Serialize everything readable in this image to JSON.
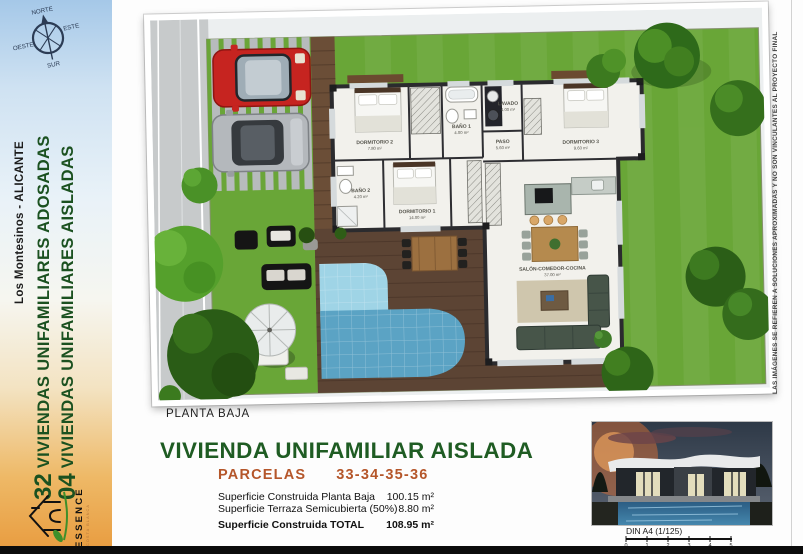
{
  "sidebar": {
    "location": "Los Montesinos - ALICANTE",
    "line1_number": "32",
    "line1_text": "VIVIENDAS UNIFAMILIARES ADOSADAS",
    "line2_number": "04",
    "line2_text": "VIVIENDAS UNIFAMILIARES AISLADAS",
    "logo_name": "ESSENCE",
    "logo_subtitle": "COSTA BLANCA",
    "colors": {
      "text_green": "#1b5120",
      "gradient_top": "#a5c8e8",
      "gradient_bottom": "#e89b3e"
    }
  },
  "compass": {
    "north": "NORTE",
    "east": "ESTE",
    "south": "SUR",
    "west": "OESTE"
  },
  "plan": {
    "caption": "PLANTA BAJA",
    "rooms": [
      {
        "name": "DORMITORIO 2",
        "area": "7.80 m²"
      },
      {
        "name": "BAÑO 1",
        "area": "4.00 m²"
      },
      {
        "name": "LAVADO",
        "area": "4.00 m²"
      },
      {
        "name": "DORMITORIO 3",
        "area": "9.60 m²"
      },
      {
        "name": "PASO",
        "area": "5.60 m²"
      },
      {
        "name": "BAÑO 2",
        "area": "4.20 m²"
      },
      {
        "name": "DORMITORIO 1",
        "area": "14.00 m²"
      },
      {
        "name": "SALÓN-COMEDOR-COCINA",
        "area": "37.00 m²"
      }
    ]
  },
  "details": {
    "title": "VIVIENDA UNIFAMILIAR AISLADA",
    "parcels_label": "PARCELAS",
    "parcels_numbers": "33-34-35-36",
    "surface_rows": [
      {
        "label": "Superficie Construida Planta Baja",
        "value": "100.15 m²"
      },
      {
        "label": "Superficie Terraza Semicubierta (50%)",
        "value": "8.80 m²"
      },
      {
        "label": "Superficie Construida TOTAL",
        "value": "108.95 m²"
      }
    ]
  },
  "footer": {
    "scale_label": "DIN A4 (1/125)",
    "scale_ticks": [
      "0",
      "1",
      "2",
      "3",
      "4",
      "5"
    ]
  },
  "disclaimer": "LAS IMÁGENES SE REFIEREN A SOLUCIONES APROXIMADAS Y NO SON VINCULANTES AL PROYECTO FINAL",
  "title_colors": {
    "title_green": "#1f5c23",
    "parcels_orange": "#b5562a"
  }
}
